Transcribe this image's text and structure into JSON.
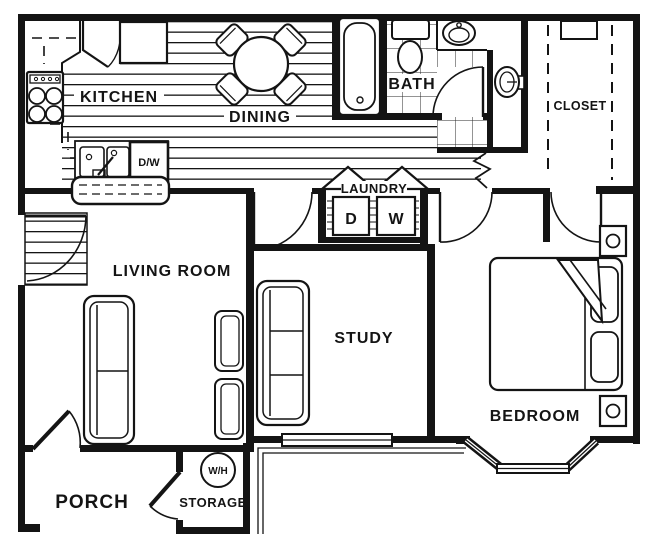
{
  "plan": {
    "title": "apartment floor plan",
    "colors": {
      "wall": "#141414",
      "background": "#ffffff"
    },
    "rooms": {
      "kitchen": {
        "label": "KITCHEN"
      },
      "dining": {
        "label": "DINING"
      },
      "bath": {
        "label": "BATH"
      },
      "closet": {
        "label": "CLOSET"
      },
      "laundry": {
        "label": "LAUNDRY",
        "dryer": "D",
        "washer": "W"
      },
      "living": {
        "label": "LIVING ROOM"
      },
      "study": {
        "label": "STUDY"
      },
      "bedroom": {
        "label": "BEDROOM"
      },
      "porch": {
        "label": "PORCH"
      },
      "storage": {
        "label": "STORAGE",
        "water_heater": "W/H"
      }
    },
    "appliances": {
      "dishwasher": "D/W"
    }
  }
}
